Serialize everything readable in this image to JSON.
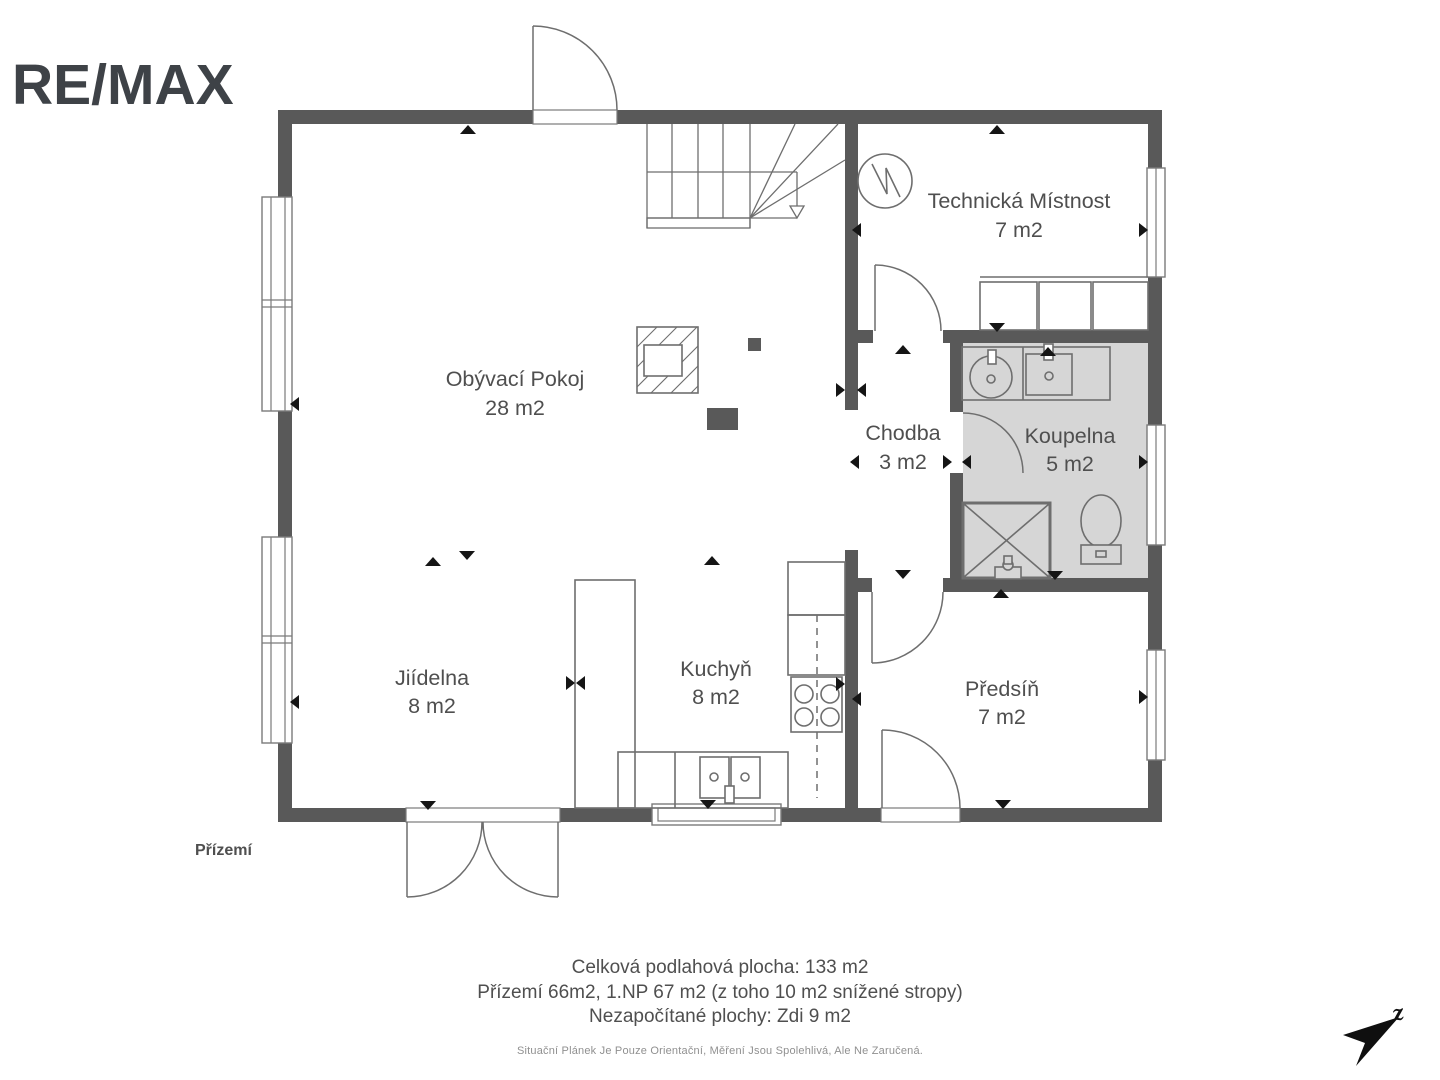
{
  "logo": {
    "brand": "RE/MAX"
  },
  "floor_label": "Přízemí",
  "rooms": [
    {
      "id": "living",
      "name": "Obývací Pokoj",
      "area": "28 m2"
    },
    {
      "id": "dining",
      "name": "Jiídelna",
      "area": "8 m2"
    },
    {
      "id": "kitchen",
      "name": "Kuchyň",
      "area": "8 m2"
    },
    {
      "id": "hallway",
      "name": "Chodba",
      "area": "3 m2"
    },
    {
      "id": "bathroom",
      "name": "Koupelna",
      "area": "5 m2"
    },
    {
      "id": "technical",
      "name": "Technická Místnost",
      "area": "7 m2"
    },
    {
      "id": "entry",
      "name": "Předsíň",
      "area": "7 m2"
    }
  ],
  "footer": {
    "line1": "Celková podlahová plocha: 133 m2",
    "line2": "Přízemí 66m2, 1.NP 67 m2 (z toho 10 m2 snížené stropy)",
    "line3": "Nezapočítané plochy: Zdi 9 m2",
    "disclaimer": "Situační Plánek Je Pouze Orientační, Měření Jsou Spolehlivá, Ale Ne Zaručená."
  },
  "compass": {
    "label": "z"
  },
  "colors": {
    "wall": "#595959",
    "bath": "#d6d6d6",
    "line": "#6e6e6e",
    "frame": "#7a7a7a",
    "text": "#4f4f4f",
    "footer": "#4f4f4f",
    "muted": "#909090",
    "logo": "#3e4247",
    "marker": "#151515",
    "compass": "#0f0f0f"
  },
  "plan": {
    "dimension_markers": [
      {
        "x": 468,
        "y": 130,
        "d": "up"
      },
      {
        "x": 997,
        "y": 130,
        "d": "up"
      },
      {
        "x": 857,
        "y": 230,
        "d": "left"
      },
      {
        "x": 1143,
        "y": 230,
        "d": "right"
      },
      {
        "x": 997,
        "y": 327,
        "d": "down"
      },
      {
        "x": 903,
        "y": 350,
        "d": "up"
      },
      {
        "x": 1048,
        "y": 352,
        "d": "up"
      },
      {
        "x": 295,
        "y": 404,
        "d": "left"
      },
      {
        "x": 840,
        "y": 390,
        "d": "right"
      },
      {
        "x": 862,
        "y": 390,
        "d": "left"
      },
      {
        "x": 855,
        "y": 462,
        "d": "left"
      },
      {
        "x": 947,
        "y": 462,
        "d": "right"
      },
      {
        "x": 967,
        "y": 462,
        "d": "left"
      },
      {
        "x": 1143,
        "y": 462,
        "d": "right"
      },
      {
        "x": 903,
        "y": 574,
        "d": "down"
      },
      {
        "x": 1055,
        "y": 575,
        "d": "down"
      },
      {
        "x": 433,
        "y": 562,
        "d": "up"
      },
      {
        "x": 467,
        "y": 555,
        "d": "down"
      },
      {
        "x": 712,
        "y": 561,
        "d": "up"
      },
      {
        "x": 1001,
        "y": 594,
        "d": "up"
      },
      {
        "x": 570,
        "y": 683,
        "d": "right"
      },
      {
        "x": 581,
        "y": 683,
        "d": "left"
      },
      {
        "x": 840,
        "y": 684,
        "d": "right"
      },
      {
        "x": 857,
        "y": 699,
        "d": "left"
      },
      {
        "x": 295,
        "y": 702,
        "d": "left"
      },
      {
        "x": 1143,
        "y": 697,
        "d": "right"
      },
      {
        "x": 428,
        "y": 805,
        "d": "down"
      },
      {
        "x": 708,
        "y": 804,
        "d": "down"
      },
      {
        "x": 1003,
        "y": 804,
        "d": "down"
      }
    ]
  }
}
